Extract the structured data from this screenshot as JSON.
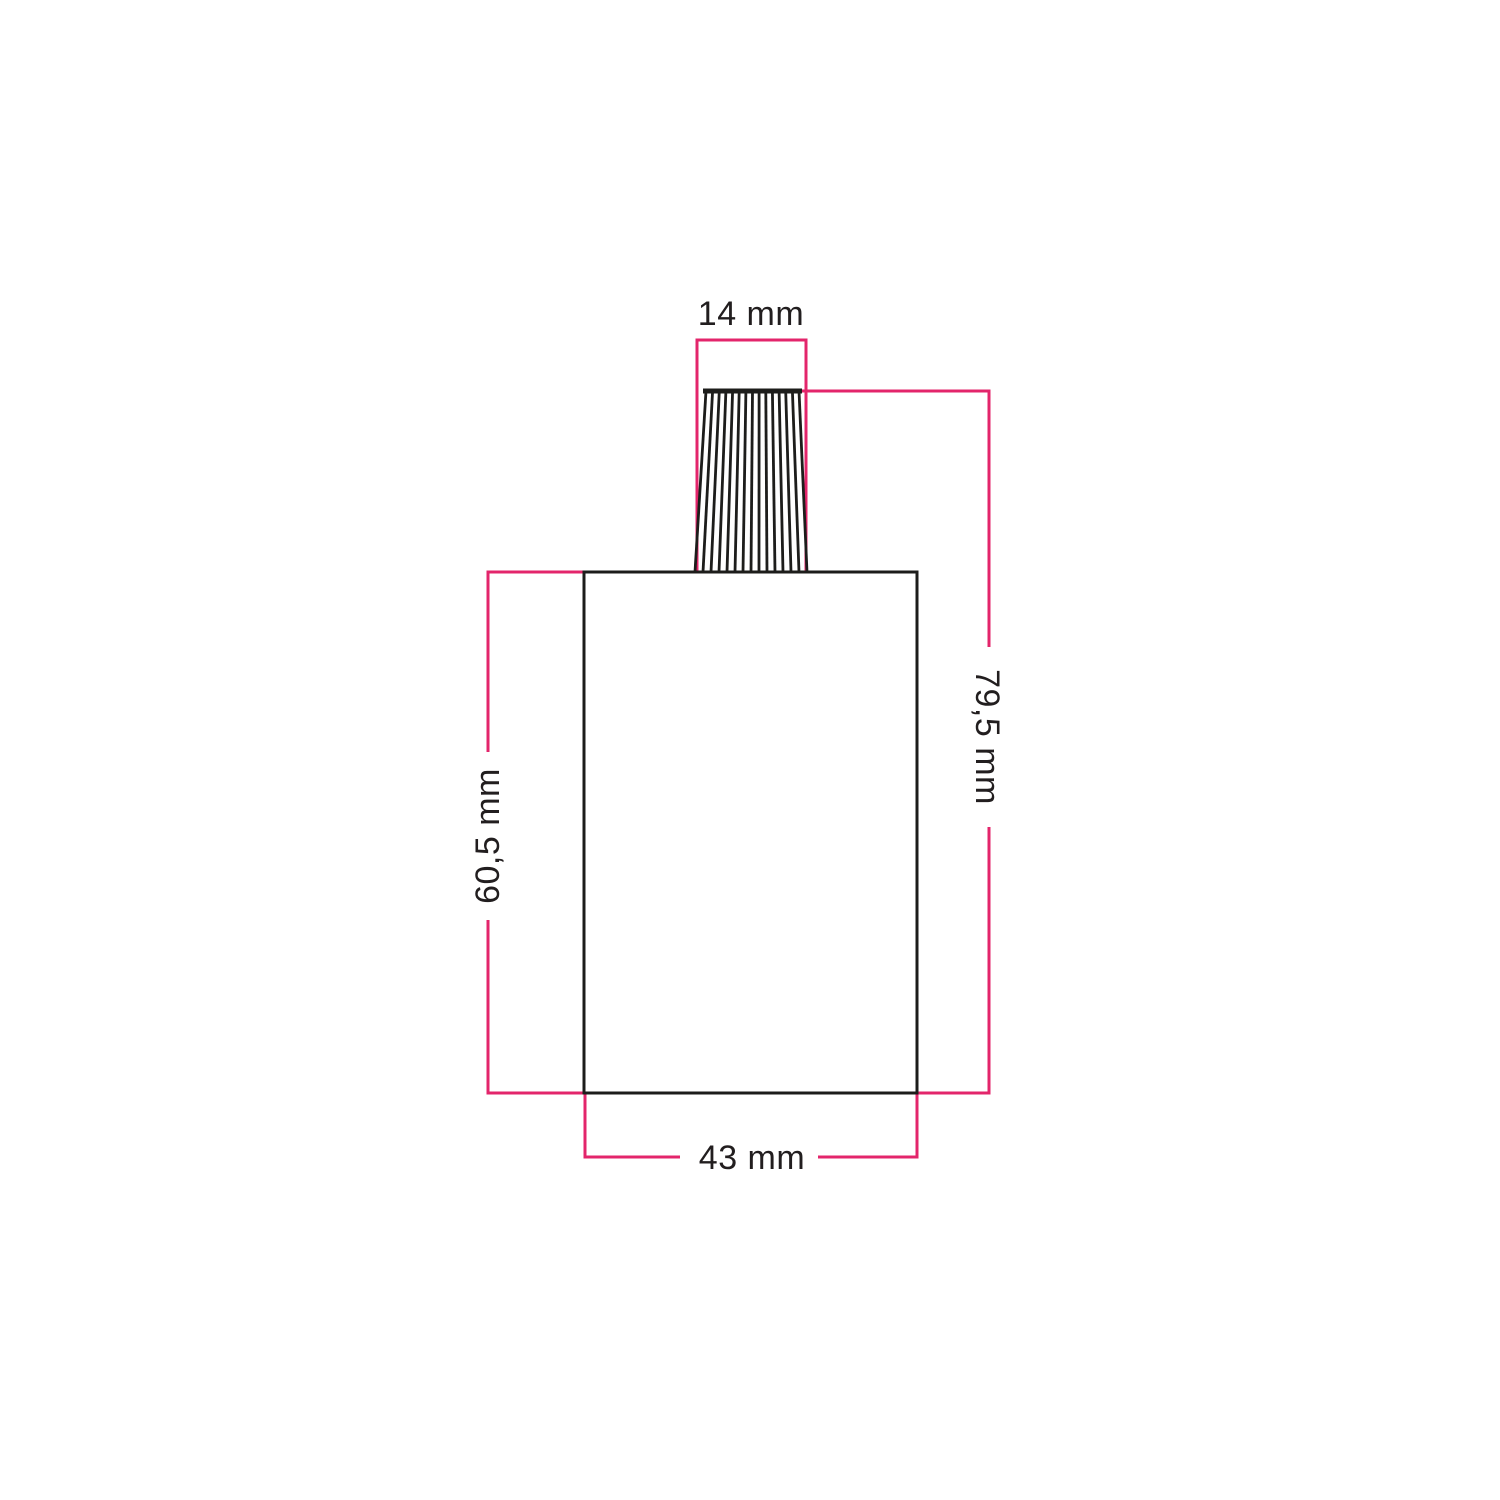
{
  "drawing": {
    "subject": "lamp-holder-with-cable-grip-dimension-drawing",
    "labels": {
      "top_width": "14 mm",
      "overall_height": "79,5 mm",
      "body_height": "60,5 mm",
      "body_width": "43 mm"
    },
    "colors": {
      "dimension": "#e3256b",
      "outline": "#1d1d1b",
      "text": "#221e1f",
      "background": "#ffffff"
    }
  }
}
